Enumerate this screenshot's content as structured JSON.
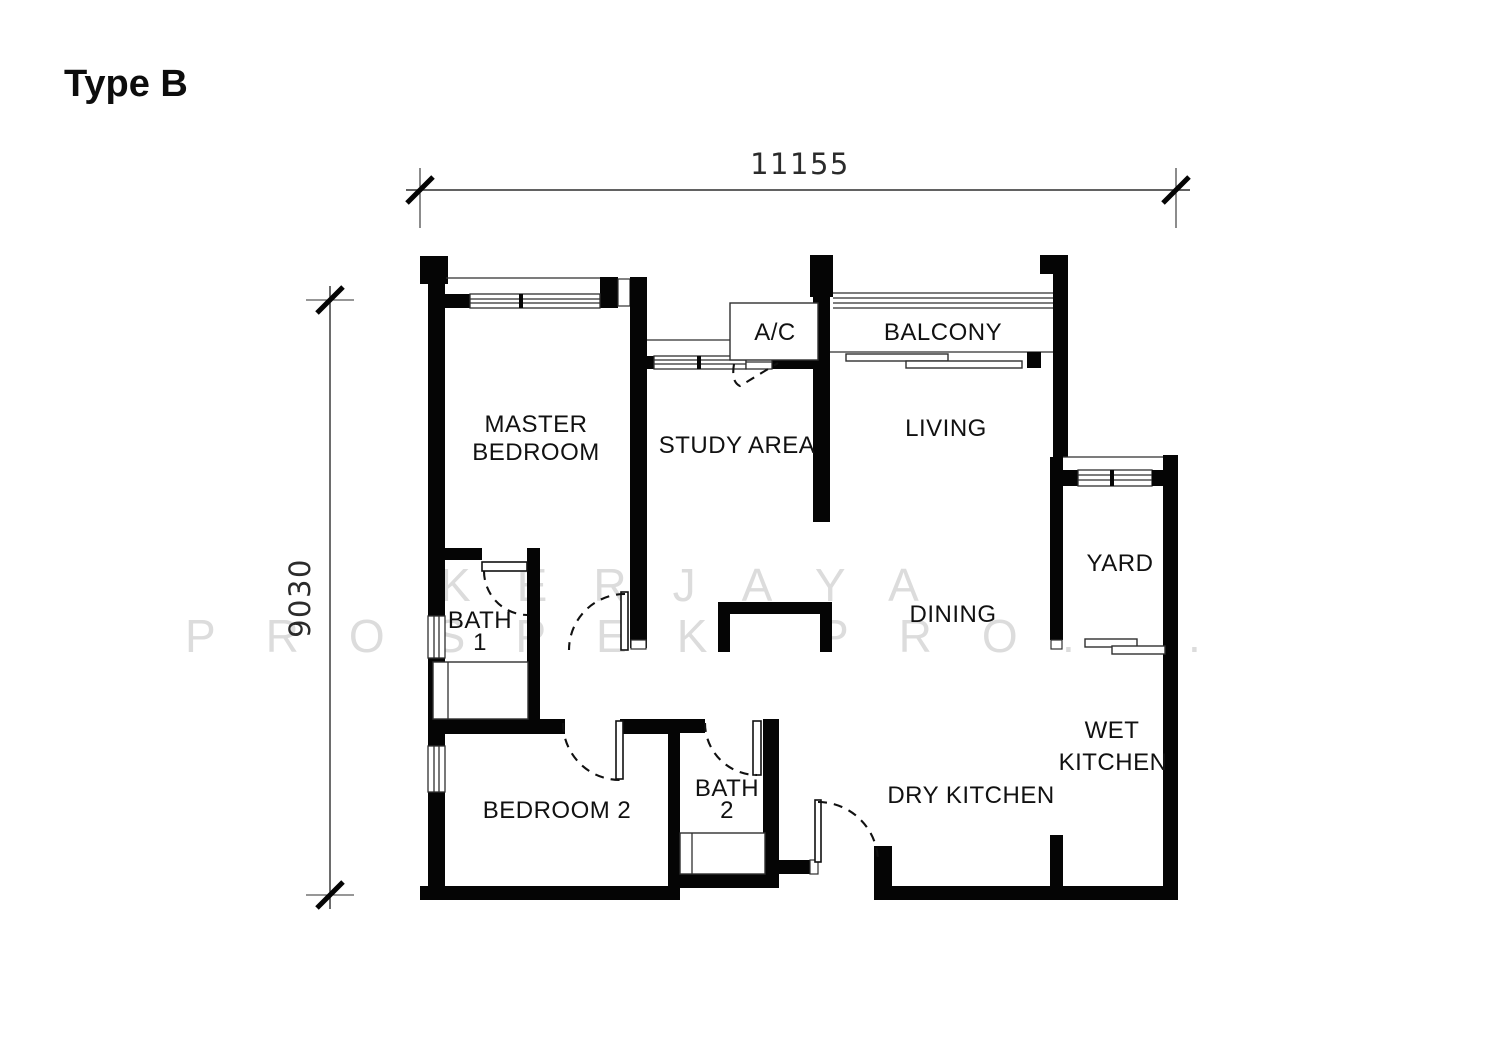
{
  "title": "Type B",
  "dimensions": {
    "horizontal": "11155",
    "vertical": "9030"
  },
  "rooms": {
    "master_bedroom": {
      "lines": [
        "MASTER",
        "BEDROOM"
      ]
    },
    "study_area": {
      "label": "STUDY AREA"
    },
    "ac_ledge": {
      "label": "A/C"
    },
    "balcony": {
      "label": "BALCONY"
    },
    "living": {
      "label": "LIVING"
    },
    "yard": {
      "label": "YARD"
    },
    "dining": {
      "label": "DINING"
    },
    "bath_1": {
      "lines": [
        "BATH",
        "1"
      ]
    },
    "bedroom_2": {
      "label": "BEDROOM 2"
    },
    "bath_2": {
      "lines": [
        "BATH",
        "2"
      ]
    },
    "dry_kitchen": {
      "label": "DRY KITCHEN"
    },
    "wet_kitchen": {
      "lines": [
        "WET",
        "KITCHEN"
      ]
    }
  },
  "watermark": {
    "line1": "KERJAYA",
    "line2_word1": "PROSPEK",
    "line2_word2": "PRO",
    "dot": "."
  },
  "colors": {
    "wall": "#000000",
    "thin_line": "#2f2f2f",
    "text": "#111111",
    "watermark": "#dcdcdc",
    "background": "#ffffff"
  }
}
